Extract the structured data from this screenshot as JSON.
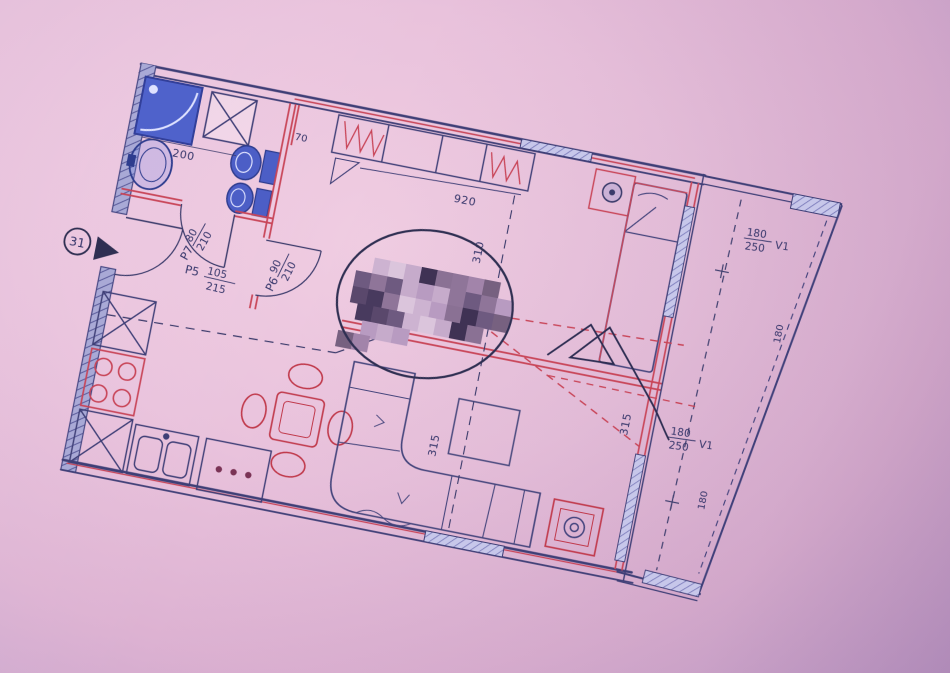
{
  "photo": {
    "bg_outer": "#ad8cc0",
    "bg_paper": "#e9c2dc"
  },
  "plan": {
    "rotation_deg": 11.2,
    "colors": {
      "wall_ink": "#3e3e76",
      "partition_red": "#c84457",
      "fixture_blue": "#4c5ec6",
      "hatch_fill": "#b8b8e2",
      "pen": "#2d2d52",
      "mosaic": [
        "#cdb3d1",
        "#8f7599",
        "#5a486c",
        "#3f3254",
        "#b89bc1",
        "#dbc5dc",
        "#a284aa",
        "#6e5a80",
        "#8a7194",
        "#483a5e",
        "#c6abcb",
        "#776180"
      ]
    },
    "unit_marker": {
      "number": "31"
    },
    "doors": {
      "entrance": {
        "code": "P5",
        "w": "105",
        "h": "215"
      },
      "bathroom": {
        "code": "P7",
        "w": "80",
        "h": "210"
      },
      "bedroom": {
        "code": "P6",
        "w": "90",
        "h": "210"
      }
    },
    "windows": {
      "balcony_top": {
        "w": "180",
        "h": "250",
        "code": "V1",
        "dim": "180"
      },
      "balcony_bottom": {
        "w": "180",
        "h": "250",
        "code": "V1",
        "dim": "180"
      }
    },
    "dimensions": {
      "bathroom_width": "200",
      "niche": "70",
      "bedroom_width": "920",
      "bedroom_depth": "310",
      "living_a": "315",
      "living_b": "315"
    },
    "censor": {
      "cell": 16,
      "rows": [
        [
          352,
          146,
          8
        ],
        [
          336,
          162,
          10
        ],
        [
          336,
          178,
          10
        ],
        [
          344,
          194,
          8
        ],
        [
          352,
          210,
          3
        ],
        [
          330,
          224,
          2
        ]
      ]
    }
  }
}
